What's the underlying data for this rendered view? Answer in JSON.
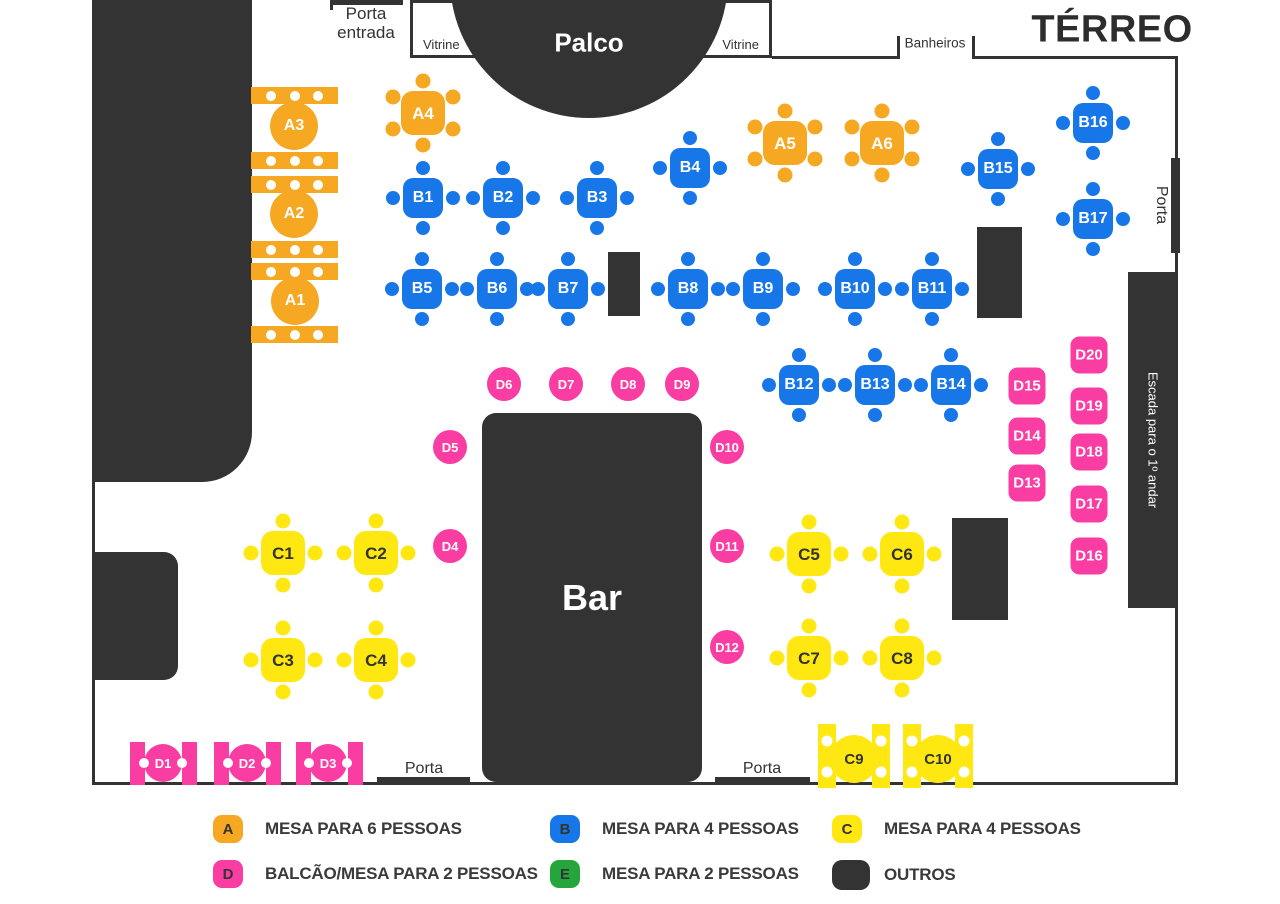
{
  "title": "TÉRREO",
  "colors": {
    "orange": "#F7A823",
    "blue": "#1877E8",
    "yellow": "#FFE712",
    "pink": "#FA3DA2",
    "green": "#26A53C",
    "dark": "#333333"
  },
  "labels": {
    "porta_entrada_line1": "Porta",
    "porta_entrada_line2": "entrada",
    "vitrine_left": "Vitrine",
    "vitrine_right": "Vitrine",
    "banheiros": "Banheiros",
    "porta_right": "Porta",
    "porta_bottom_left": "Porta",
    "porta_bottom_right": "Porta"
  },
  "structures": {
    "stage": {
      "x": 450,
      "y": -160,
      "size": 278,
      "label": "Palco"
    },
    "bar": {
      "x": 482,
      "y": 413,
      "w": 220,
      "h": 369,
      "label": "Bar"
    },
    "stairs": {
      "x": 1128,
      "y": 272,
      "w": 50,
      "h": 336,
      "label": "Escada para o 1º andar"
    },
    "walls": [
      {
        "name": "left-wall",
        "x": 92,
        "y": 0,
        "w": 160,
        "h": 482,
        "r": "0 0 50px 0"
      },
      {
        "name": "left-wall-line",
        "x": 92,
        "y": 482,
        "w": 3,
        "h": 302
      },
      {
        "name": "bottom-wall",
        "x": 92,
        "y": 782,
        "w": 1086,
        "h": 3
      },
      {
        "name": "right-wall",
        "x": 1175,
        "y": 56,
        "w": 3,
        "h": 727
      },
      {
        "name": "top-wall-left-of-banheiros",
        "x": 772,
        "y": 56,
        "w": 126,
        "h": 3
      },
      {
        "name": "top-wall-right-of-banheiros",
        "x": 973,
        "y": 56,
        "w": 205,
        "h": 3
      },
      {
        "name": "banheiros-tick-left",
        "x": 897,
        "y": 36,
        "w": 3,
        "h": 23
      },
      {
        "name": "banheiros-tick-right",
        "x": 972,
        "y": 36,
        "w": 3,
        "h": 23
      },
      {
        "name": "entrance-wall-tick",
        "x": 330,
        "y": 0,
        "w": 3,
        "h": 10
      },
      {
        "name": "entrance-door-bar",
        "x": 330,
        "y": 0,
        "w": 73,
        "h": 5
      }
    ],
    "doors": [
      {
        "name": "door-bottom-left",
        "x": 377,
        "y": 777,
        "w": 93,
        "h": 8
      },
      {
        "name": "door-bottom-right",
        "x": 715,
        "y": 777,
        "w": 95,
        "h": 8
      },
      {
        "name": "door-right",
        "x": 1171,
        "y": 158,
        "w": 9,
        "h": 95
      }
    ],
    "pillars": [
      {
        "x": 608,
        "y": 252,
        "w": 32,
        "h": 64
      },
      {
        "x": 977,
        "y": 227,
        "w": 45,
        "h": 91
      },
      {
        "x": 952,
        "y": 518,
        "w": 56,
        "h": 102
      },
      {
        "x": 95,
        "y": 552,
        "w": 83,
        "h": 128,
        "r": "0 14px 14px 0"
      }
    ]
  },
  "tables": {
    "a_square": [
      {
        "id": "A4",
        "x": 423,
        "y": 113
      },
      {
        "id": "A5",
        "x": 785,
        "y": 143
      },
      {
        "id": "A6",
        "x": 882,
        "y": 143
      }
    ],
    "a_round": [
      {
        "id": "A3",
        "x": 294,
        "y": 126,
        "benches": [
          87,
          152
        ]
      },
      {
        "id": "A2",
        "x": 294,
        "y": 214,
        "benches": [
          176,
          241
        ]
      },
      {
        "id": "A1",
        "x": 295,
        "y": 301,
        "benches": [
          263,
          326
        ]
      }
    ],
    "a_bench": {
      "x": 251,
      "w": 87,
      "h": 17,
      "dot_offsets": [
        20,
        43.5,
        67
      ]
    },
    "b": [
      {
        "id": "B1",
        "x": 423,
        "y": 198
      },
      {
        "id": "B2",
        "x": 503,
        "y": 198
      },
      {
        "id": "B3",
        "x": 597,
        "y": 198
      },
      {
        "id": "B4",
        "x": 690,
        "y": 168
      },
      {
        "id": "B5",
        "x": 422,
        "y": 289
      },
      {
        "id": "B6",
        "x": 497,
        "y": 289
      },
      {
        "id": "B7",
        "x": 568,
        "y": 289
      },
      {
        "id": "B8",
        "x": 688,
        "y": 289
      },
      {
        "id": "B9",
        "x": 763,
        "y": 289
      },
      {
        "id": "B10",
        "x": 855,
        "y": 289
      },
      {
        "id": "B11",
        "x": 932,
        "y": 289
      },
      {
        "id": "B12",
        "x": 799,
        "y": 385
      },
      {
        "id": "B13",
        "x": 875,
        "y": 385
      },
      {
        "id": "B14",
        "x": 951,
        "y": 385
      },
      {
        "id": "B15",
        "x": 998,
        "y": 169
      },
      {
        "id": "B16",
        "x": 1093,
        "y": 123
      },
      {
        "id": "B17",
        "x": 1093,
        "y": 219
      }
    ],
    "c_square": [
      {
        "id": "C1",
        "x": 283,
        "y": 553
      },
      {
        "id": "C2",
        "x": 376,
        "y": 553
      },
      {
        "id": "C3",
        "x": 283,
        "y": 660
      },
      {
        "id": "C4",
        "x": 376,
        "y": 660
      },
      {
        "id": "C5",
        "x": 809,
        "y": 554
      },
      {
        "id": "C6",
        "x": 902,
        "y": 554
      },
      {
        "id": "C7",
        "x": 809,
        "y": 658
      },
      {
        "id": "C8",
        "x": 902,
        "y": 658
      }
    ],
    "c_counter": [
      {
        "id": "C9",
        "x": 854,
        "y": 759,
        "bars": [
          818,
          872
        ]
      },
      {
        "id": "C10",
        "x": 938,
        "y": 759,
        "bars": [
          903,
          955
        ]
      }
    ],
    "c_counter_bar": {
      "w": 18,
      "h": 64,
      "y": 724,
      "dot_ys": [
        741,
        772
      ]
    },
    "d_counter": [
      {
        "id": "D1",
        "x": 163,
        "y": 763,
        "bars": [
          130,
          182
        ]
      },
      {
        "id": "D2",
        "x": 247,
        "y": 763,
        "bars": [
          214,
          266
        ]
      },
      {
        "id": "D3",
        "x": 328,
        "y": 763,
        "bars": [
          296,
          348
        ]
      }
    ],
    "d_counter_bar": {
      "w": 15,
      "h": 43,
      "y": 742
    },
    "d_circle": [
      {
        "id": "D4",
        "x": 450,
        "y": 546
      },
      {
        "id": "D5",
        "x": 450,
        "y": 447
      },
      {
        "id": "D6",
        "x": 504,
        "y": 384
      },
      {
        "id": "D7",
        "x": 566,
        "y": 384
      },
      {
        "id": "D8",
        "x": 628,
        "y": 384
      },
      {
        "id": "D9",
        "x": 682,
        "y": 384
      },
      {
        "id": "D10",
        "x": 727,
        "y": 447
      },
      {
        "id": "D11",
        "x": 727,
        "y": 546
      },
      {
        "id": "D12",
        "x": 727,
        "y": 647
      }
    ],
    "d_square": [
      {
        "id": "D13",
        "x": 1027,
        "y": 483
      },
      {
        "id": "D14",
        "x": 1027,
        "y": 436
      },
      {
        "id": "D15",
        "x": 1027,
        "y": 386
      },
      {
        "id": "D16",
        "x": 1089,
        "y": 556
      },
      {
        "id": "D17",
        "x": 1089,
        "y": 504
      },
      {
        "id": "D18",
        "x": 1089,
        "y": 452
      },
      {
        "id": "D19",
        "x": 1089,
        "y": 406
      },
      {
        "id": "D20",
        "x": 1089,
        "y": 355
      }
    ]
  },
  "legend": {
    "items": [
      {
        "letter": "A",
        "color": "orange",
        "label": "MESA PARA 6 PESSOAS",
        "col": 0,
        "row": 0
      },
      {
        "letter": "B",
        "color": "blue",
        "label": "MESA PARA 4 PESSOAS",
        "col": 1,
        "row": 0
      },
      {
        "letter": "C",
        "color": "yellow",
        "label": "MESA PARA 4 PESSOAS",
        "col": 2,
        "row": 0
      },
      {
        "letter": "D",
        "color": "pink",
        "label": "BALCÃO/MESA PARA 2 PESSOAS",
        "col": 0,
        "row": 1
      },
      {
        "letter": "E",
        "color": "green",
        "label": "MESA PARA 2 PESSOAS",
        "col": 1,
        "row": 1
      },
      {
        "letter": "",
        "color": "dark",
        "label": "OUTROS",
        "col": 2,
        "row": 1
      }
    ]
  }
}
